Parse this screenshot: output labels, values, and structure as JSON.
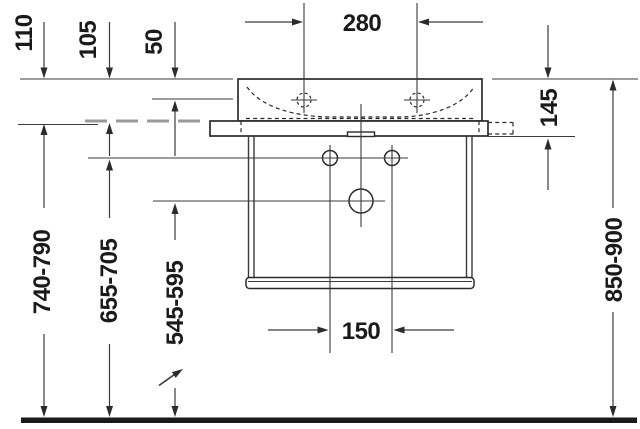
{
  "diagram": {
    "title": "Wall-mounted washbasin with console — front-view installation drawing",
    "unit": "mm",
    "labels": {
      "dim_280": "280",
      "dim_110": "110",
      "dim_105": "105",
      "dim_50": "50",
      "dim_145": "145",
      "dim_150": "150",
      "dim_545_595": "545-595",
      "dim_655_705": "655-705",
      "dim_740_790": "740-790",
      "dim_850_900": "850-900"
    },
    "colors": {
      "line": "#3a3a3a",
      "outline": "#2b2b2b",
      "text": "#1a1a1a",
      "hidden_gray": "#9a9a9a",
      "floor": "#1a1a1a",
      "background": "#ffffff"
    }
  }
}
